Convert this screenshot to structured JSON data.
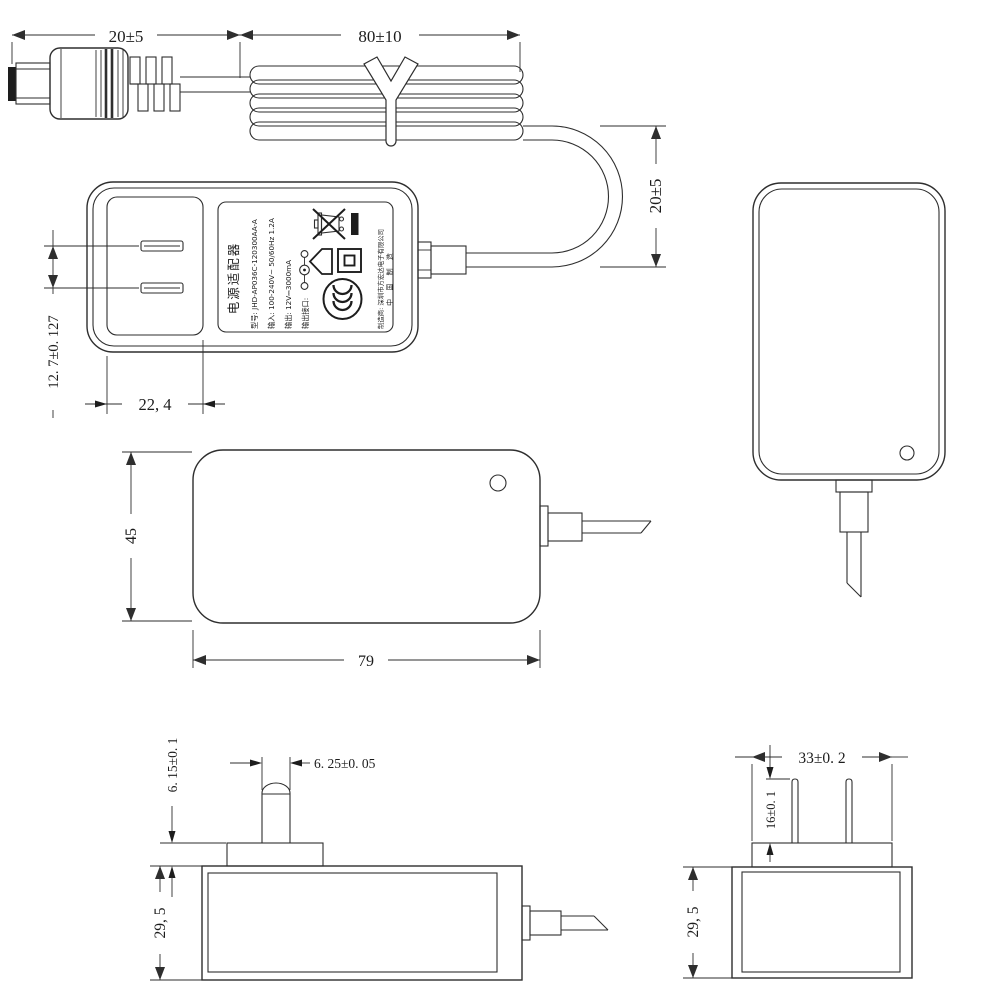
{
  "dimensions": {
    "dc_plug_length": "20±5",
    "cord_coil_length": "80±10",
    "cord_loop_height": "20±5",
    "pin_pitch": "12. 7±0. 127",
    "plug_face_width": "22, 4",
    "front_body_height": "45",
    "front_body_length": "79",
    "riser_height": "6. 15±0. 1",
    "blade_width": "6. 25±0. 05",
    "side_body_thickness": "29, 5",
    "riser_width": "33±0. 2",
    "blade_length": "16±0. 1",
    "end_body_thickness": "29, 5"
  },
  "label": {
    "title": "电源适配器",
    "model": "型号: JHD-AP036C-120300AA-A",
    "input": "输入: 100-240V~ 50/60Hz 1.2A",
    "output": "输出: 12V⎓3000mA",
    "output_port": "输出接口:",
    "manufacturer": "制造商: 深圳市方宏达电子有限公司",
    "made_in": "中 国 制 造"
  },
  "colors": {
    "line": "#2e2e2e",
    "background": "#ffffff"
  }
}
